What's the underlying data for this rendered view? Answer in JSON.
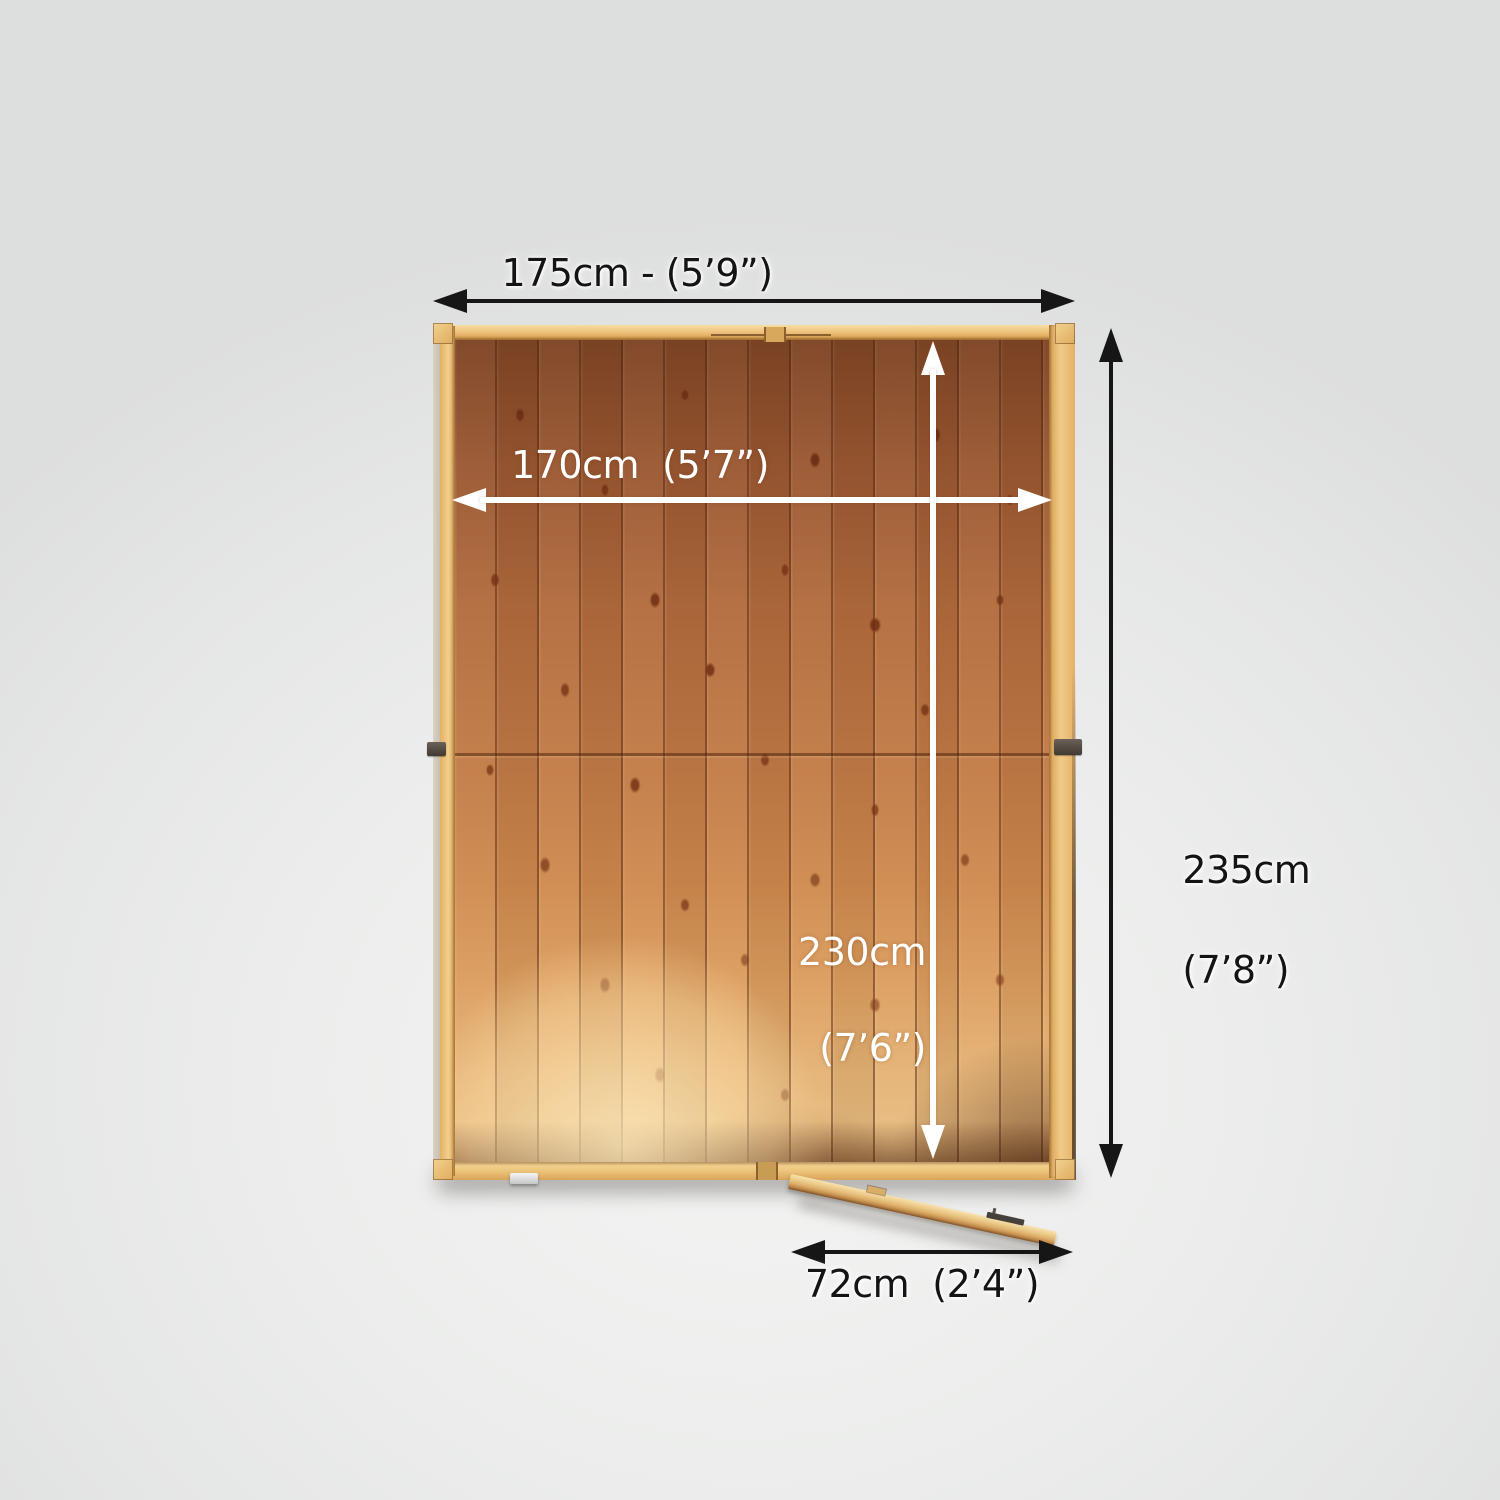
{
  "diagram": {
    "name": "garden-shed-top-view-dimension-diagram",
    "view": "top-down floor plan of wooden shed with detached door panel",
    "dimensions": [
      {
        "id": "external-width",
        "label": "175cm - (5’9”)",
        "arrow": "black",
        "position": "top"
      },
      {
        "id": "internal-width",
        "label": "170cm  (5’7”)",
        "arrow": "white",
        "position": "inside-top"
      },
      {
        "id": "internal-depth",
        "label_lines": [
          "230cm",
          "(7’6”)"
        ],
        "arrow": "white",
        "position": "inside-right"
      },
      {
        "id": "external-depth",
        "label_lines": [
          "235cm",
          "(7’8”)"
        ],
        "arrow": "black",
        "position": "right"
      },
      {
        "id": "door-width",
        "label": "72cm  (2’4”)",
        "arrow": "black",
        "position": "bottom"
      }
    ],
    "colors": {
      "arrow_dark": "#161616",
      "arrow_light": "#ffffff",
      "label_dark": "#141414",
      "label_light": "#ffffff",
      "background_gray": "#e9eaea",
      "frame_wood": "#eec47e",
      "plank_wood_dark": "#a05d33",
      "plank_wood_light": "#e7bc80"
    }
  }
}
